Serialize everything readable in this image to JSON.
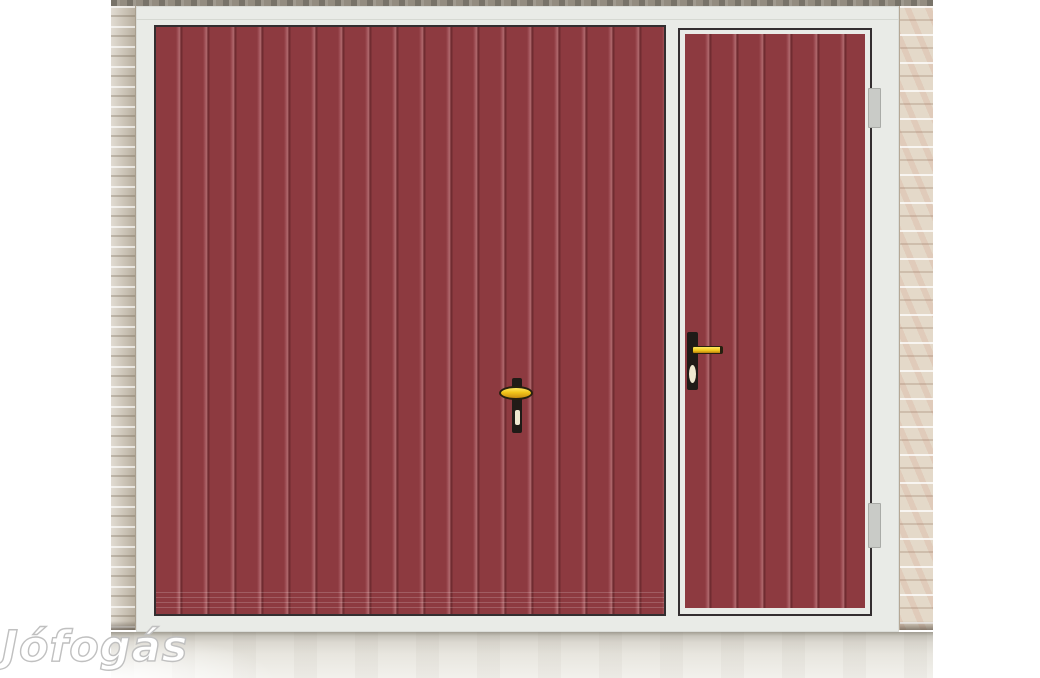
{
  "image": {
    "type": "classified-ad product photo",
    "subject": "Dark red vertically-ribbed garage door with an integrated side pedestrian door, white frame, light brick pillars on both sides and a concrete floor"
  },
  "watermark": {
    "text": "Jófogás"
  },
  "colors": {
    "door_red": "#8d3a40",
    "rib_light": "#b26b6f",
    "rib_dark": "#702c31",
    "door_outline": "#332e30",
    "frame_white": "#e9ebe7",
    "brick_left": "#c9bfae",
    "brick_right": "#e4d9c9",
    "lintel_grey": "#938c80",
    "concrete": "#e8e6df",
    "handle_gold": "#f0c419",
    "handle_black": "#201b17",
    "keyhole_cream": "#efe8d0",
    "hinge_grey": "#c9cbc7"
  },
  "scene": {
    "parts": [
      "lintel strip",
      "left brick pillar",
      "right brick pillar",
      "white garage frame",
      "main ribbed garage door",
      "garage T-handle with gold knob and keyhole",
      "side pedestrian door with white inner frame",
      "side door gold lever handle with keyhole",
      "two hinges on right jamb",
      "concrete floor",
      "Jófogás watermark"
    ]
  }
}
